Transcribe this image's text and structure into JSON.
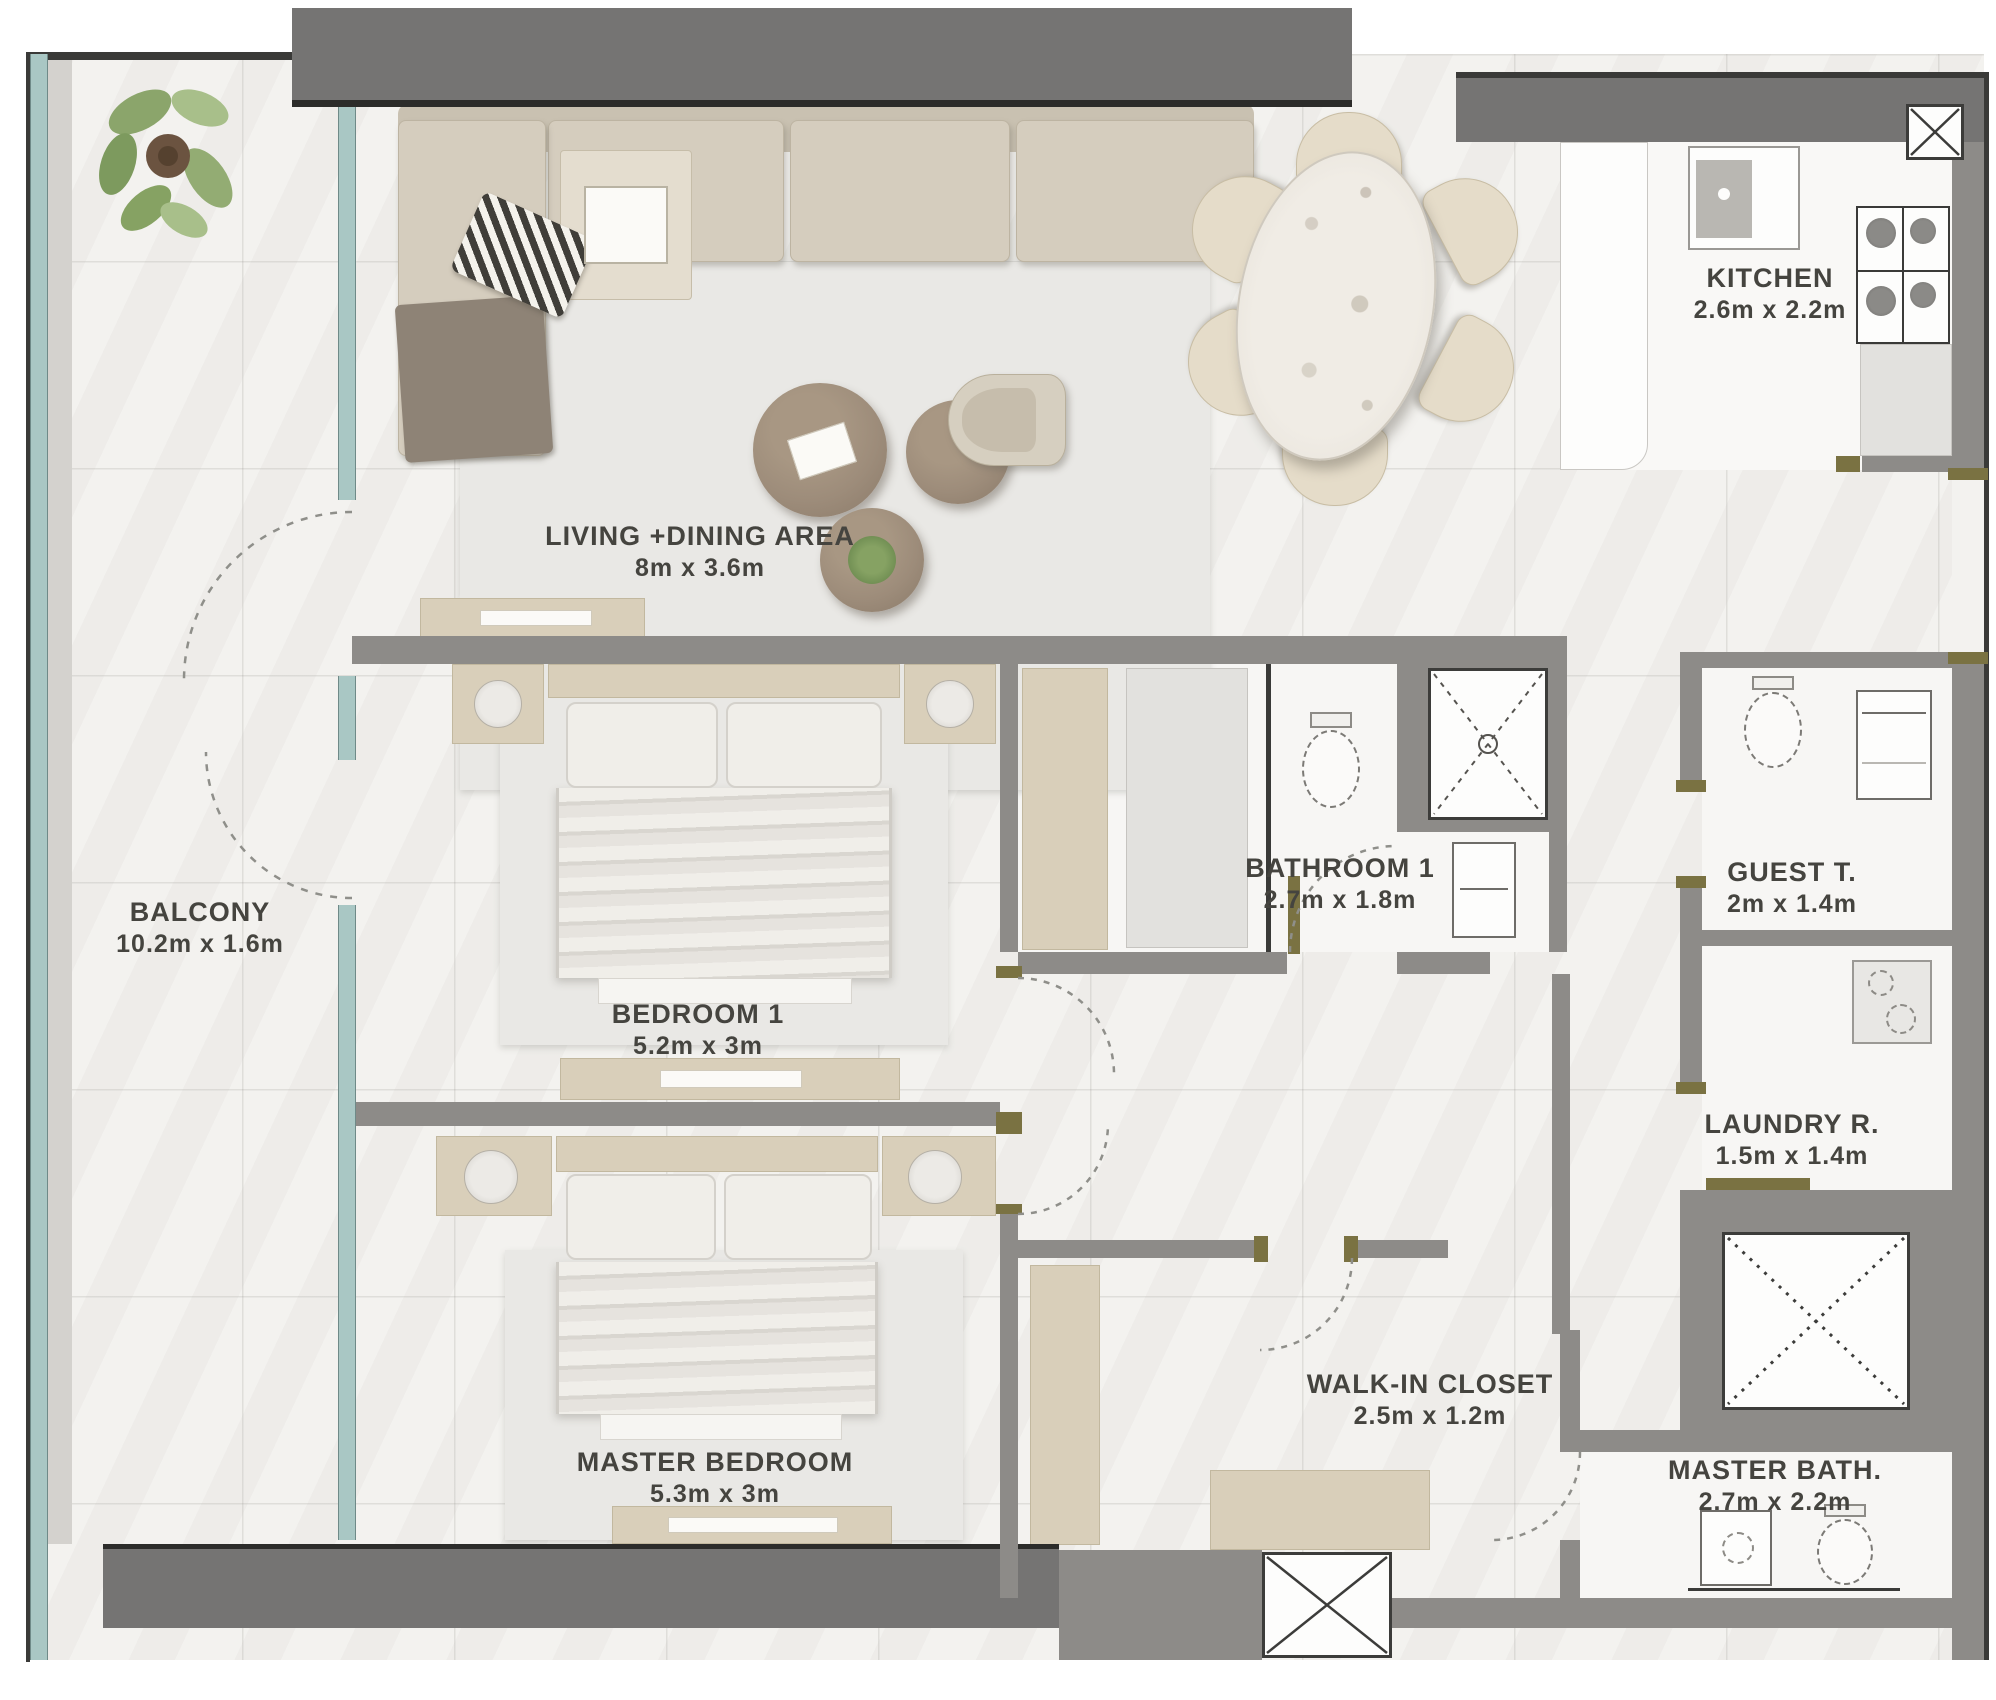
{
  "plan": {
    "title": "Apartment floor plan",
    "width_px": 1996,
    "height_px": 1700
  },
  "rooms": [
    {
      "id": "balcony",
      "name": "BALCONY",
      "dims": "10.2m x 1.6m"
    },
    {
      "id": "living-dining",
      "name": "LIVING +DINING AREA",
      "dims": "8m x 3.6m"
    },
    {
      "id": "kitchen",
      "name": "KITCHEN",
      "dims": "2.6m x 2.2m"
    },
    {
      "id": "bedroom-1",
      "name": "BEDROOM 1",
      "dims": "5.2m x 3m"
    },
    {
      "id": "bathroom-1",
      "name": "BATHROOM 1",
      "dims": "2.7m x 1.8m"
    },
    {
      "id": "guest-toilet",
      "name": "GUEST T.",
      "dims": "2m x 1.4m"
    },
    {
      "id": "laundry",
      "name": "LAUNDRY R.",
      "dims": "1.5m x 1.4m"
    },
    {
      "id": "walk-in-closet",
      "name": "WALK-IN CLOSET",
      "dims": "2.5m x 1.2m"
    },
    {
      "id": "master-bedroom",
      "name": "MASTER BEDROOM",
      "dims": "5.3m x 3m"
    },
    {
      "id": "master-bath",
      "name": "MASTER BATH.",
      "dims": "2.7m x 2.2m"
    }
  ],
  "furniture_icons": [
    "l-shaped-sofa-icon",
    "checkered-pillow-icon",
    "throw-blanket-icon",
    "tray-table-icon",
    "area-rug-icon",
    "coffee-table-icon",
    "plant-pot-icon",
    "armchair-icon",
    "dining-table-icon",
    "dining-chair-icon",
    "double-bed-icon",
    "nightstand-icon",
    "bedside-lamp-icon",
    "dresser-console-icon",
    "wardrobe-icon",
    "bench-icon",
    "balcony-plant-icon"
  ],
  "fixture_icons": [
    "kitchen-sink-icon",
    "gas-stove-icon",
    "counter-icon",
    "toilet-icon",
    "washbasin-icon",
    "shower-icon",
    "washing-machine-icon",
    "vanity-icon",
    "service-shaft-icon",
    "door-swing-icon"
  ],
  "colors": {
    "wall": "#8d8b88",
    "slab": "#757473",
    "outline": "#3a3a38",
    "glass_teal": "#a9c7c4",
    "floor": "#f3f2ef",
    "wood_tan": "#d9cfba",
    "sofa_beige": "#d5cdbe",
    "rug_gray": "#e9e8e5",
    "table_brown": "#9d8c7a",
    "door_olive": "#7a7242",
    "label_text": "#45443f"
  }
}
